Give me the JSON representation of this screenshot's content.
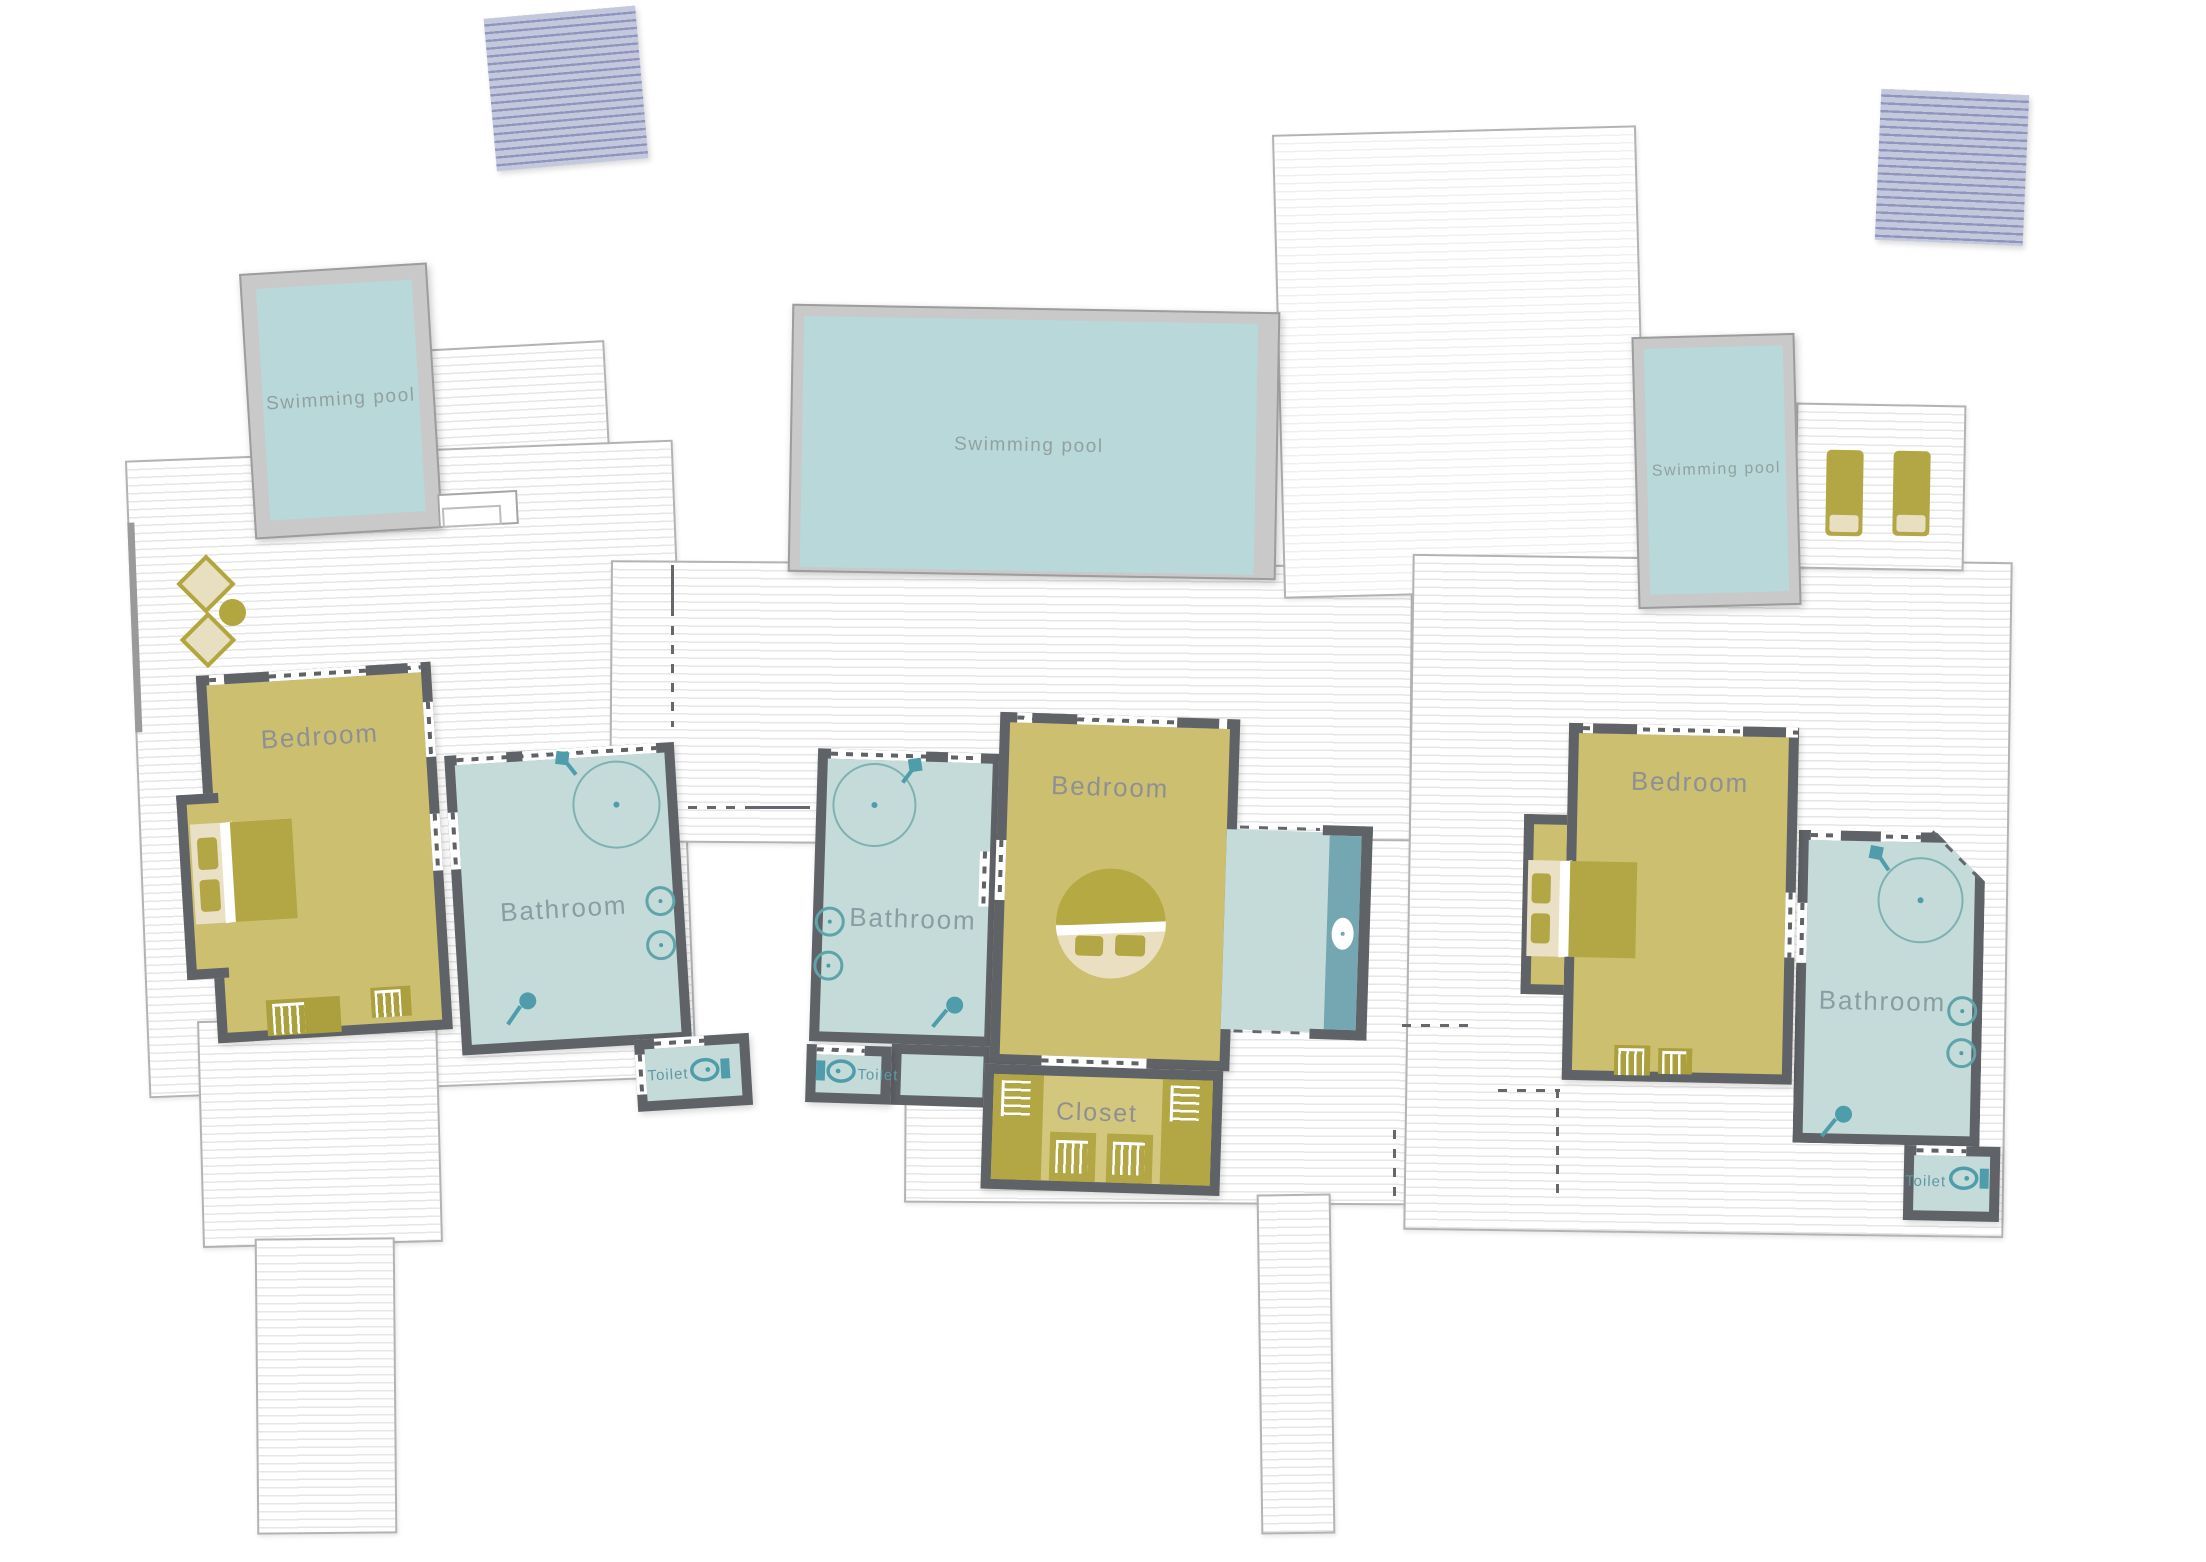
{
  "title": "Villa floor plan",
  "labels": {
    "swimming_pool": "Swimming pool",
    "bedroom": "Bedroom",
    "bathroom": "Bathroom",
    "toilet": "Toilet",
    "closet": "Closet"
  },
  "pools": [
    {
      "id": "pool-left",
      "label": "Swimming pool"
    },
    {
      "id": "pool-center",
      "label": "Swimming pool"
    },
    {
      "id": "pool-right",
      "label": "Swimming pool"
    }
  ],
  "suites": [
    {
      "id": "suite-left",
      "bedroom_label": "Bedroom",
      "bathroom_label": "Bathroom",
      "toilet_label": "Toilet"
    },
    {
      "id": "suite-center",
      "bedroom_label": "Bedroom",
      "bathroom_label": "Bathroom",
      "toilet_label": "Toilet",
      "closet_label": "Closet"
    },
    {
      "id": "suite-right",
      "bedroom_label": "Bedroom",
      "bathroom_label": "Bathroom",
      "toilet_label": "Toilet"
    }
  ],
  "colors": {
    "wall": "#5f6266",
    "bedroom_fill": "#cdbf70",
    "furniture_olive": "#b3a644",
    "mattress_cream": "#eae0c5",
    "bathroom_fill": "#c5dbd9",
    "fixture_teal": "#4f9dab",
    "pool_water": "#b9d8da",
    "pool_frame": "#c9c9c9",
    "deck_stripe": "#e6e6e6",
    "pergola_fill": "#c4c8dc",
    "pergola_stripe": "#8e95be",
    "label_gray": "#8e9093",
    "pool_label_gray": "#93a0a0"
  },
  "icons": {
    "shower": "circle-outline-with-center-dot",
    "shower-head": "diamond-with-stem",
    "sink": "circle-with-dot-on-wall",
    "toilet": "bowl-with-tank",
    "floor-drain-pin": "lollipop-pin",
    "double-bed": "rect-with-two-pillows",
    "round-bed": "circle-bed-with-two-pillows",
    "rug": "fringed-rect",
    "wardrobe-fringe": "comb-marks",
    "sun-lounger": "rect-with-cushion",
    "armchair": "rotated-square",
    "side-table": "filled-circle",
    "pergola": "striped-square",
    "pool-steps": "nested-rectangles"
  }
}
